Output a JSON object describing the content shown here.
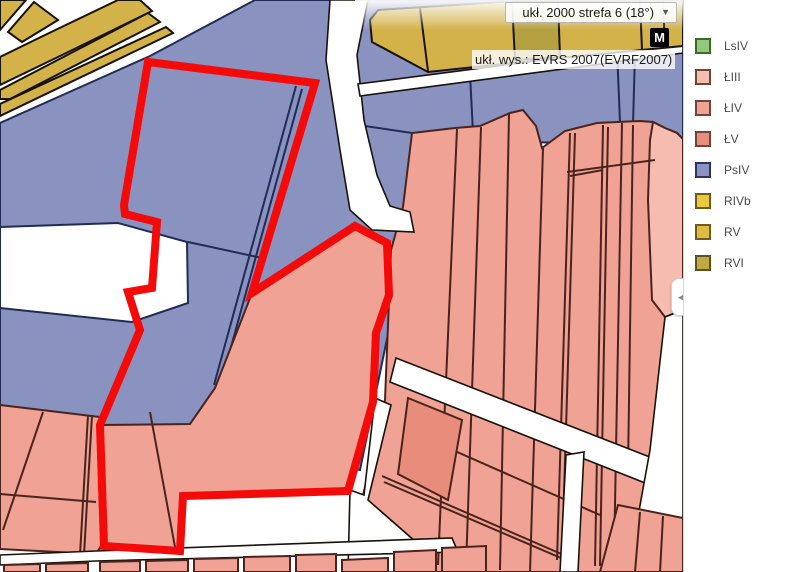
{
  "header": {
    "crs_selector_label": "ukł. 2000 strefa 6 (18°)",
    "crs_dropdown_arrow": "▼",
    "marker_button_label": "M",
    "height_system_label": "ukł. wys.: EVRS 2007(EVRF2007)"
  },
  "legend": {
    "collapse_arrow": "◀",
    "items": [
      {
        "label": "LsIV",
        "fill": "#94C97C",
        "border": "#3E6B28"
      },
      {
        "label": "ŁIII",
        "fill": "#F7BDAE",
        "border": "#70453A"
      },
      {
        "label": "ŁIV",
        "fill": "#F2A294",
        "border": "#70453A"
      },
      {
        "label": "ŁV",
        "fill": "#E98D7C",
        "border": "#70453A"
      },
      {
        "label": "PsIV",
        "fill": "#8A92C2",
        "border": "#2A3764"
      },
      {
        "label": "RIVb",
        "fill": "#EBC83E",
        "border": "#6E5C1C"
      },
      {
        "label": "RV",
        "fill": "#DCBC41",
        "border": "#6E5C1C"
      },
      {
        "label": "RVI",
        "fill": "#C0A945",
        "border": "#5C5420"
      }
    ]
  },
  "map": {
    "colors": {
      "blue": "#8A92C0",
      "navy": "#202C55",
      "salmon": "#F0A294",
      "salmonLight": "#F6BCAF",
      "salmonDark": "#E88D7B",
      "yellow": "#D3B24A",
      "yellowDark": "#B3A03E",
      "lineBlack": "#17120B",
      "brown": "#4A241C",
      "red": "#F50A0A",
      "road": "#FFFFFF"
    }
  }
}
